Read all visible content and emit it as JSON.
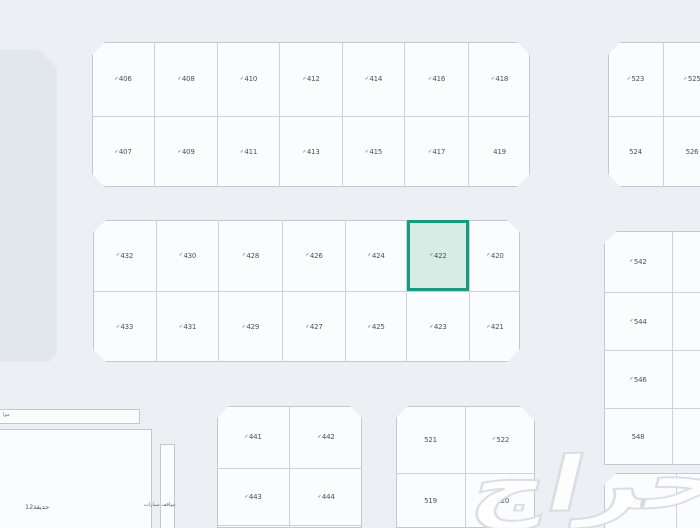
{
  "canvas": {
    "width": 700,
    "height": 528,
    "background": "#ecf0f4"
  },
  "watermark": {
    "text": "حراج"
  },
  "icons": {
    "check_glyph": "✓"
  },
  "colors": {
    "plot_fill": "#fbfcfd",
    "plot_line": "#c3c8ce",
    "highlight_fill": "#d8ece6",
    "highlight_border": "#169a80",
    "park_fill": "#e2e7ee"
  },
  "zones": {
    "strip_label": "موا",
    "garden_label": "حديقة12",
    "parking_text": "مواقف سيارات"
  },
  "highlight": {
    "plot": "422"
  },
  "blocks": [
    {
      "id": "north-west",
      "x": 92,
      "y": 42,
      "w": 438,
      "h": 145,
      "chamfer": [
        13,
        13,
        13,
        13
      ],
      "colWidths": [
        62,
        63,
        62,
        63,
        62,
        64,
        62
      ],
      "rowHeights": [
        74,
        71
      ],
      "plots": [
        [
          {
            "n": "406",
            "c": true
          },
          {
            "n": "408",
            "c": true
          },
          {
            "n": "410",
            "c": true
          },
          {
            "n": "412",
            "c": true
          },
          {
            "n": "414",
            "c": true
          },
          {
            "n": "416",
            "c": true
          },
          {
            "n": "418",
            "c": true
          }
        ],
        [
          {
            "n": "407",
            "c": true
          },
          {
            "n": "409",
            "c": true
          },
          {
            "n": "411",
            "c": true
          },
          {
            "n": "413",
            "c": true
          },
          {
            "n": "415",
            "c": true
          },
          {
            "n": "417",
            "c": true
          },
          {
            "n": "419",
            "c": false
          }
        ]
      ]
    },
    {
      "id": "north-east",
      "x": 608,
      "y": 42,
      "w": 112,
      "h": 145,
      "chamfer": [
        13,
        0,
        0,
        13
      ],
      "colWidths": [
        55,
        57
      ],
      "rowHeights": [
        74,
        71
      ],
      "plots": [
        [
          {
            "n": "523",
            "c": true
          },
          {
            "n": "525",
            "c": true
          }
        ],
        [
          {
            "n": "524",
            "c": false
          },
          {
            "n": "526",
            "c": false
          }
        ]
      ]
    },
    {
      "id": "center-west",
      "x": 93,
      "y": 220,
      "w": 427,
      "h": 142,
      "chamfer": [
        13,
        13,
        13,
        13
      ],
      "colWidths": [
        63,
        62,
        64,
        63,
        61,
        63,
        51
      ],
      "rowHeights": [
        71,
        71
      ],
      "plots": [
        [
          {
            "n": "432",
            "c": true
          },
          {
            "n": "430",
            "c": true
          },
          {
            "n": "428",
            "c": true
          },
          {
            "n": "426",
            "c": true
          },
          {
            "n": "424",
            "c": true
          },
          {
            "n": "422",
            "c": true,
            "hl": true
          },
          {
            "n": "420",
            "c": true
          }
        ],
        [
          {
            "n": "433",
            "c": true
          },
          {
            "n": "431",
            "c": true
          },
          {
            "n": "429",
            "c": true
          },
          {
            "n": "427",
            "c": true
          },
          {
            "n": "425",
            "c": true
          },
          {
            "n": "423",
            "c": true
          },
          {
            "n": "421",
            "c": true
          }
        ]
      ]
    },
    {
      "id": "center-east",
      "x": 604,
      "y": 231,
      "w": 116,
      "h": 234,
      "chamfer": [
        13,
        0,
        0,
        0
      ],
      "colWidths": [
        68,
        48
      ],
      "rowHeights": [
        61,
        58,
        58,
        57
      ],
      "plots": [
        [
          {
            "n": "542",
            "c": true
          },
          {
            "n": "",
            "c": false
          }
        ],
        [
          {
            "n": "544",
            "c": true
          },
          {
            "n": "",
            "c": false
          }
        ],
        [
          {
            "n": "546",
            "c": true
          },
          {
            "n": "",
            "c": false
          }
        ],
        [
          {
            "n": "548",
            "c": false
          },
          {
            "n": "",
            "c": false
          }
        ]
      ]
    },
    {
      "id": "south-west",
      "x": 217,
      "y": 406,
      "w": 145,
      "h": 122,
      "chamfer": [
        12,
        12,
        0,
        0
      ],
      "colWidths": [
        72,
        73
      ],
      "rowHeights": [
        62,
        57,
        3
      ],
      "plots": [
        [
          {
            "n": "441",
            "c": true
          },
          {
            "n": "442",
            "c": true
          }
        ],
        [
          {
            "n": "443",
            "c": true
          },
          {
            "n": "444",
            "c": true
          }
        ],
        [
          {
            "n": "",
            "c": false
          },
          {
            "n": "",
            "c": false
          }
        ]
      ]
    },
    {
      "id": "south-center",
      "x": 396,
      "y": 406,
      "w": 139,
      "h": 122,
      "chamfer": [
        12,
        15,
        0,
        0
      ],
      "colWidths": [
        69,
        70
      ],
      "rowHeights": [
        67,
        55
      ],
      "plots": [
        [
          {
            "n": "521",
            "c": false
          },
          {
            "n": "522",
            "c": true
          }
        ],
        [
          {
            "n": "519",
            "c": false
          },
          {
            "n": "520",
            "c": true
          }
        ]
      ]
    },
    {
      "id": "south-east",
      "x": 604,
      "y": 473,
      "w": 116,
      "h": 60,
      "chamfer": [
        12,
        0,
        0,
        0
      ],
      "colWidths": [
        72,
        44
      ],
      "rowHeights": [
        60
      ],
      "plots": [
        [
          {
            "n": "550",
            "c": false
          },
          {
            "n": "",
            "c": false
          }
        ]
      ]
    }
  ]
}
